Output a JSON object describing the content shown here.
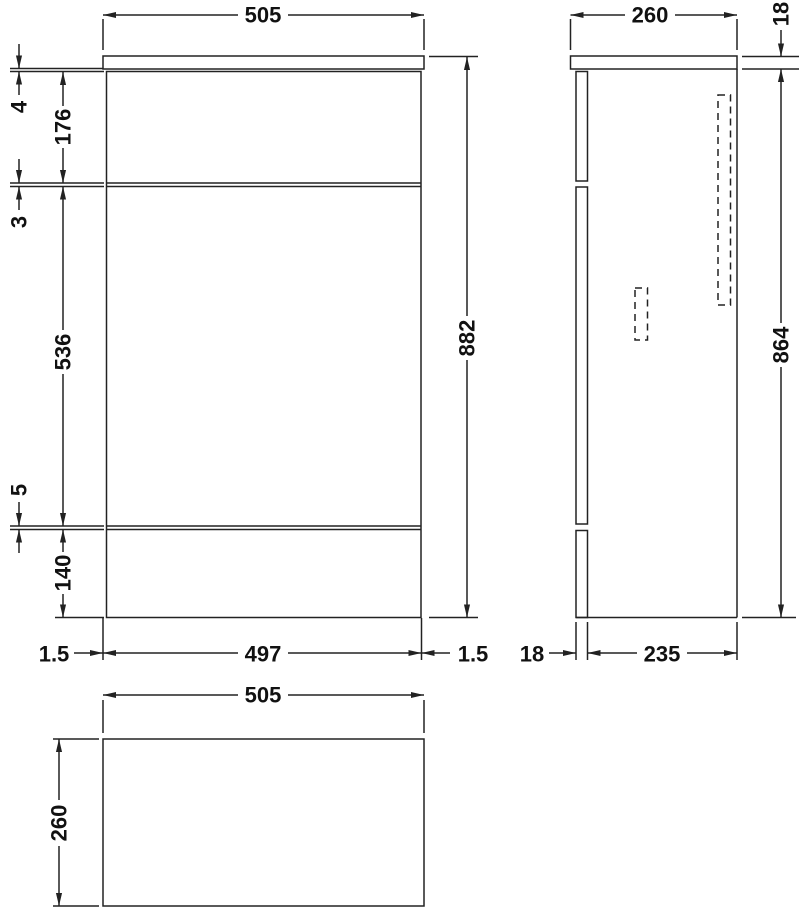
{
  "colors": {
    "line": "#222222",
    "text": "#111111",
    "background": "#ffffff"
  },
  "dims": {
    "front": {
      "top_width": "505",
      "worktop_gap": "4",
      "upper_section": "176",
      "top_reveal": "3",
      "mid_section": "536",
      "bottom_reveal": "5",
      "plinth": "140",
      "overall_height": "882",
      "left_edge": "1.5",
      "carcass_width": "497",
      "right_edge": "1.5"
    },
    "side": {
      "top_depth": "260",
      "worktop_thickness": "18",
      "body_height": "864",
      "front_panel": "18",
      "carcass_depth": "235"
    },
    "plan": {
      "width": "505",
      "depth": "260"
    }
  }
}
